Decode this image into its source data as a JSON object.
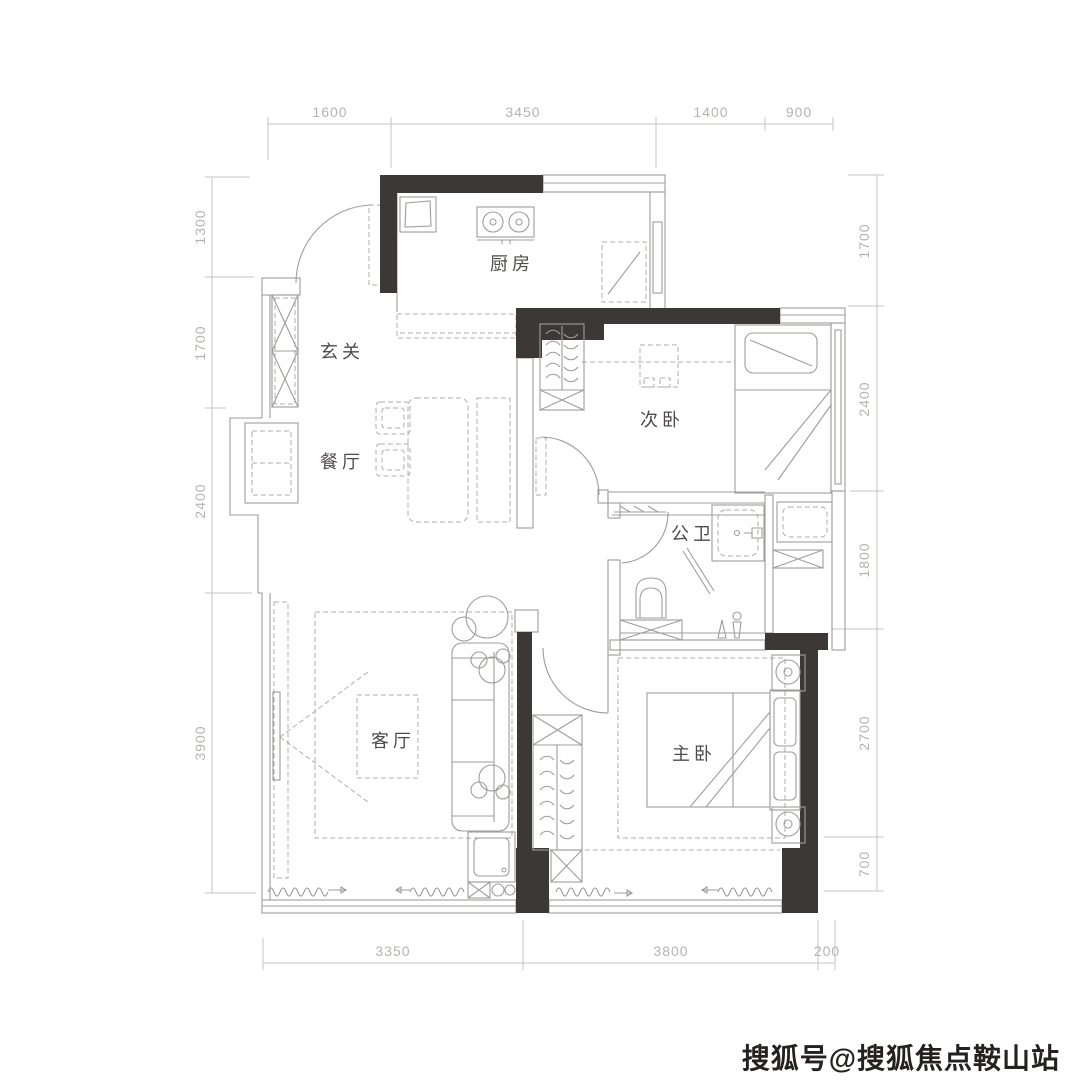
{
  "floorplan": {
    "title": "两室户型平面图",
    "rooms": {
      "kitchen": {
        "label": "厨房"
      },
      "entry": {
        "label": "玄关"
      },
      "dining": {
        "label": "餐厅"
      },
      "bedroom2": {
        "label": "次卧"
      },
      "bathroom": {
        "label": "公卫"
      },
      "living": {
        "label": "客厅"
      },
      "master": {
        "label": "主卧"
      }
    },
    "dimensions": {
      "top": [
        "1600",
        "3450",
        "1400",
        "900"
      ],
      "bottom": [
        "3350",
        "3800",
        "200"
      ],
      "left": [
        "1300",
        "1700",
        "2400",
        "3900"
      ],
      "right": [
        "1700",
        "2400",
        "1800",
        "2700",
        "700"
      ]
    },
    "colors": {
      "wall": "#3b3837",
      "line": "#9f9d9b",
      "dash": "#aeaca9",
      "dim_line": "#c7c5c2",
      "dim_text": "#b5b3b0",
      "room_text": "#4e4b4a",
      "watermark": "#242120",
      "background": "#ffffff"
    }
  },
  "watermark": {
    "text": "搜狐号@搜狐焦点鞍山站"
  }
}
